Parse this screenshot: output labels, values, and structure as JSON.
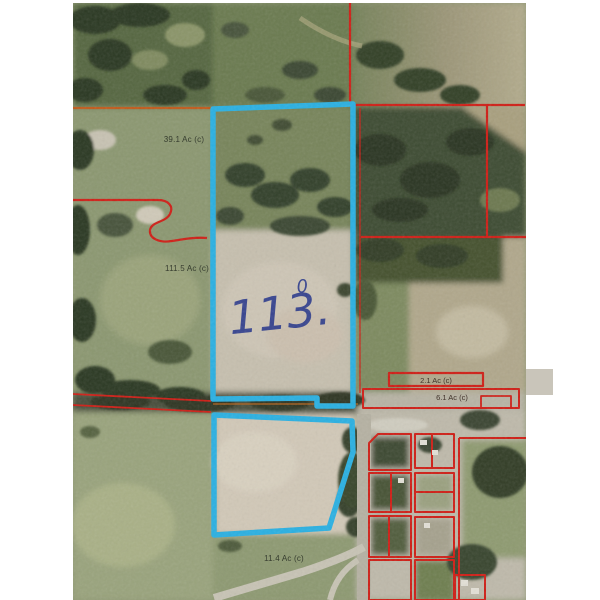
{
  "map": {
    "kind": "aerial-parcel-plat-photo",
    "handwritten_note": {
      "value": "113.",
      "superscript": "0"
    },
    "parcel_labels": [
      {
        "id": "parcel-39-1",
        "text": "39.1 Ac (c)"
      },
      {
        "id": "parcel-111-5",
        "text": "111.5 Ac (c)"
      },
      {
        "id": "parcel-2-1",
        "text": "2.1 Ac (c)"
      },
      {
        "id": "parcel-6-1",
        "text": "6.1 Ac (c)"
      },
      {
        "id": "parcel-11-4",
        "text": "11.4 Ac (c)"
      }
    ],
    "colors": {
      "boundary_red": "#cf1d15",
      "boundary_orange": "#c05a1a",
      "highlight_blue": "#29b0e2",
      "ink_blue": "#2b3a8c"
    }
  }
}
